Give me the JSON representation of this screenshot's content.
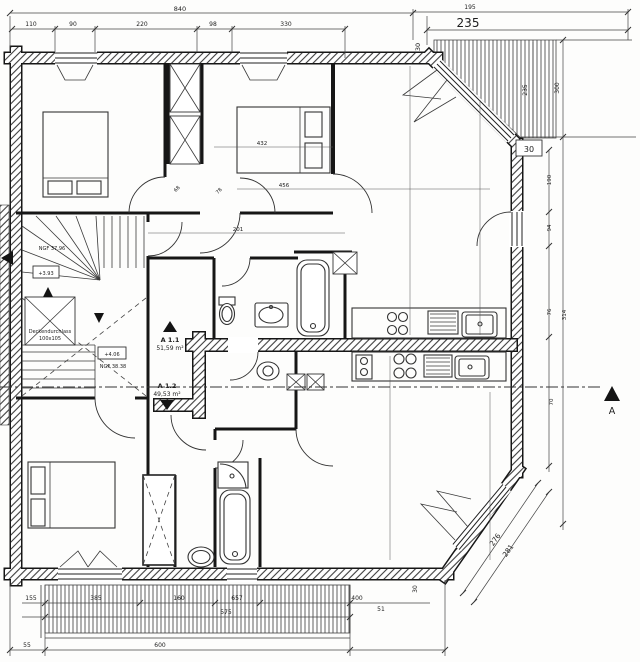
{
  "apartments": {
    "a11": {
      "name": "A 1.1",
      "area": "51,59 m²"
    },
    "a12": {
      "name": "A 1.2",
      "area": "49,53 m²"
    }
  },
  "stairwell": {
    "ngf_top": "NGF 37.96",
    "level_top": "+3.93",
    "opening_line1": "Deckendurchlass",
    "opening_line2": "100x105",
    "level_mid": "+4.06",
    "ngf_mid": "NGF 38.38"
  },
  "section": {
    "label": "A"
  },
  "dims": {
    "top_total": "840",
    "top_195": "195",
    "top_235": "235",
    "top_row": [
      "110",
      "90",
      "220",
      "98",
      "330"
    ],
    "top_chamfer_30": "30",
    "right_235": "235",
    "right_300": "300",
    "right_box_30": "30",
    "right_chain": [
      "190",
      "94",
      "76",
      "314",
      "70"
    ],
    "interior": [
      "432",
      "456",
      "201",
      "68",
      "78"
    ],
    "bottom_55": "55",
    "bottom_600": "600",
    "balcony_row": [
      "155",
      "385",
      "160",
      "657"
    ],
    "balcony_575": "575",
    "corner_400": "400",
    "corner_51": "51",
    "corner_30": "30",
    "diag_276": "276",
    "diag_281": "281"
  }
}
